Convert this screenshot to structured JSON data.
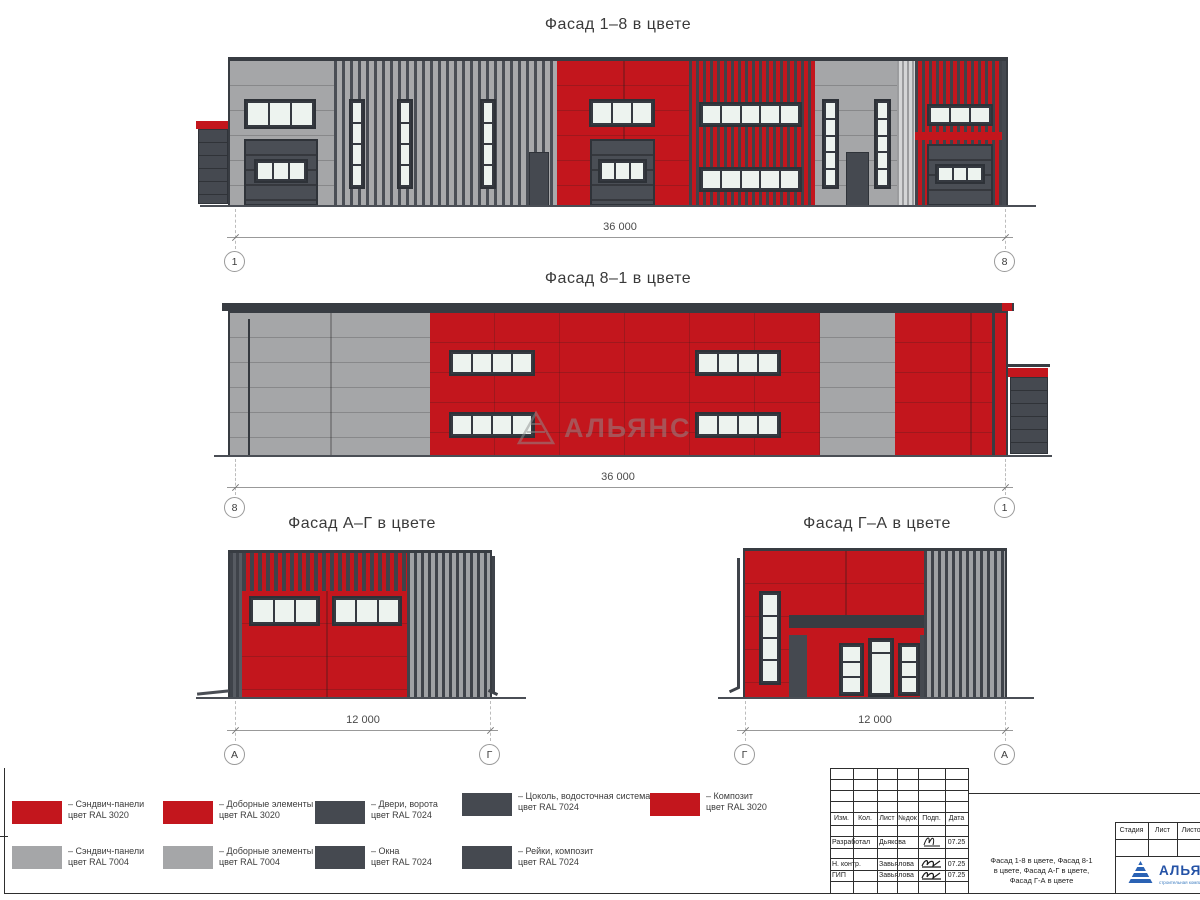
{
  "facades": {
    "f18": {
      "title": "Фасад 1–8 в цвете",
      "dim": "36 000",
      "axis_left": "1",
      "axis_right": "8"
    },
    "f81": {
      "title": "Фасад 8–1 в цвете",
      "dim": "36 000",
      "axis_left": "8",
      "axis_right": "1"
    },
    "fag": {
      "title": "Фасад А–Г в цвете",
      "dim": "12 000",
      "axis_left": "А",
      "axis_right": "Г"
    },
    "fga": {
      "title": "Фасад Г–А в цвете",
      "dim": "12 000",
      "axis_left": "Г",
      "axis_right": "А"
    }
  },
  "watermark": {
    "text": "АЛЬЯНС"
  },
  "legend": {
    "items": [
      {
        "color": "#C3161D",
        "line1": "– Сэндвич-панели",
        "line2": "цвет RAL 3020"
      },
      {
        "color": "#C3161D",
        "line1": "– Доборные элементы",
        "line2": "цвет RAL 3020"
      },
      {
        "color": "#454950",
        "line1": "– Двери, ворота",
        "line2": "цвет RAL 7024"
      },
      {
        "color": "#454950",
        "line1": "– Цоколь, водосточная система",
        "line2": "цвет RAL 7024"
      },
      {
        "color": "#C3161D",
        "line1": "– Композит",
        "line2": "цвет RAL 3020"
      },
      {
        "color": "#A5A6A8",
        "line1": "– Сэндвич-панели",
        "line2": "цвет RAL 7004"
      },
      {
        "color": "#A5A6A8",
        "line1": "– Доборные элементы",
        "line2": "цвет RAL 7004"
      },
      {
        "color": "#454950",
        "line1": "– Окна",
        "line2": "цвет RAL 7024"
      },
      {
        "color": "#454950",
        "line1": "– Рейки, композит",
        "line2": "цвет RAL 7024"
      }
    ]
  },
  "title_block": {
    "header_cols": [
      "Изм.",
      "Кол.",
      "Лист",
      "№док",
      "Подп.",
      "Дата"
    ],
    "rows": [
      {
        "role": "Разработал",
        "name": "Дьякова",
        "date": "07.25"
      },
      {
        "role": "Н. контр.",
        "name": "Завьялова",
        "date": "07.25"
      },
      {
        "role": "ГИП",
        "name": "Завьялова",
        "date": "07.25"
      }
    ],
    "doc_title": [
      "Фасад 1-8 в цвете, Фасад 8-1",
      "в цвете, Фасад А-Г в цвете,",
      "Фасад Г-А в цвете"
    ],
    "stage_col": "Стадия",
    "sheet_col": "Лист",
    "sheets_col": "Листов",
    "logo": {
      "text": "АЛЬЯНС",
      "subtext": "строительная компания"
    }
  },
  "colors": {
    "ral3020_red": "#C3161D",
    "ral7004_gray": "#A5A6A8",
    "ral7024_dark": "#454950",
    "glass": "#EDF3EF",
    "logo_blue": "#2452A6"
  }
}
